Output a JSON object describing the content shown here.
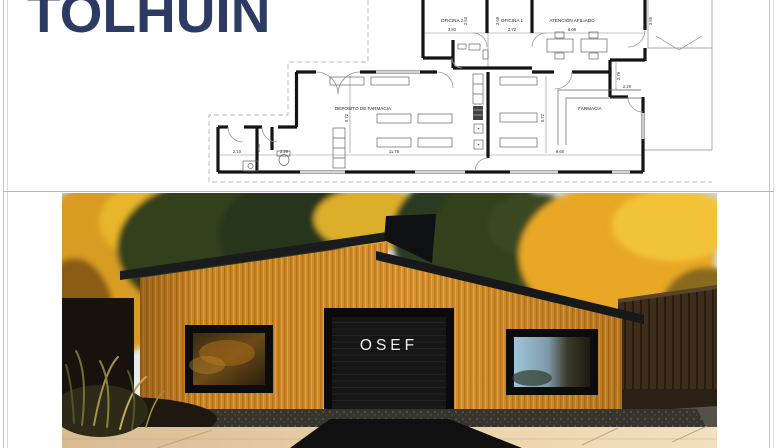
{
  "page": {
    "title": "TOLHUIN"
  },
  "floor_plan": {
    "room_labels": {
      "oficina2": "OFICINA 2",
      "oficina1": "OFICINA 1",
      "atencion": "ATENCIÓN AFILIADO",
      "deposito": "DEPOSITO DE FARMACIA",
      "farmacia": "FARMACIA"
    },
    "dims": {
      "oficina2_w": "3.82",
      "oficina2_d": "2.53",
      "oficina1_w": "2.72",
      "oficina1_d": "3.68",
      "atencion_w": "6.08",
      "atencion_d": "3.55",
      "pasillo_d": "2.79",
      "acceso_w": "2.20",
      "deposito_w": "11.78",
      "deposito_d": "5.72",
      "farmacia_w": "9.60",
      "farmacia_d": "5.72",
      "bano1_w": "2.10",
      "bano_d": "2.30",
      "bano2_w": "2.29"
    }
  },
  "photo": {
    "sign_text": "OSEF"
  },
  "colors": {
    "title_navy": "#2c3a64",
    "wood": "#d08a28",
    "roof": "#17181a",
    "wall_ink": "#141414"
  }
}
